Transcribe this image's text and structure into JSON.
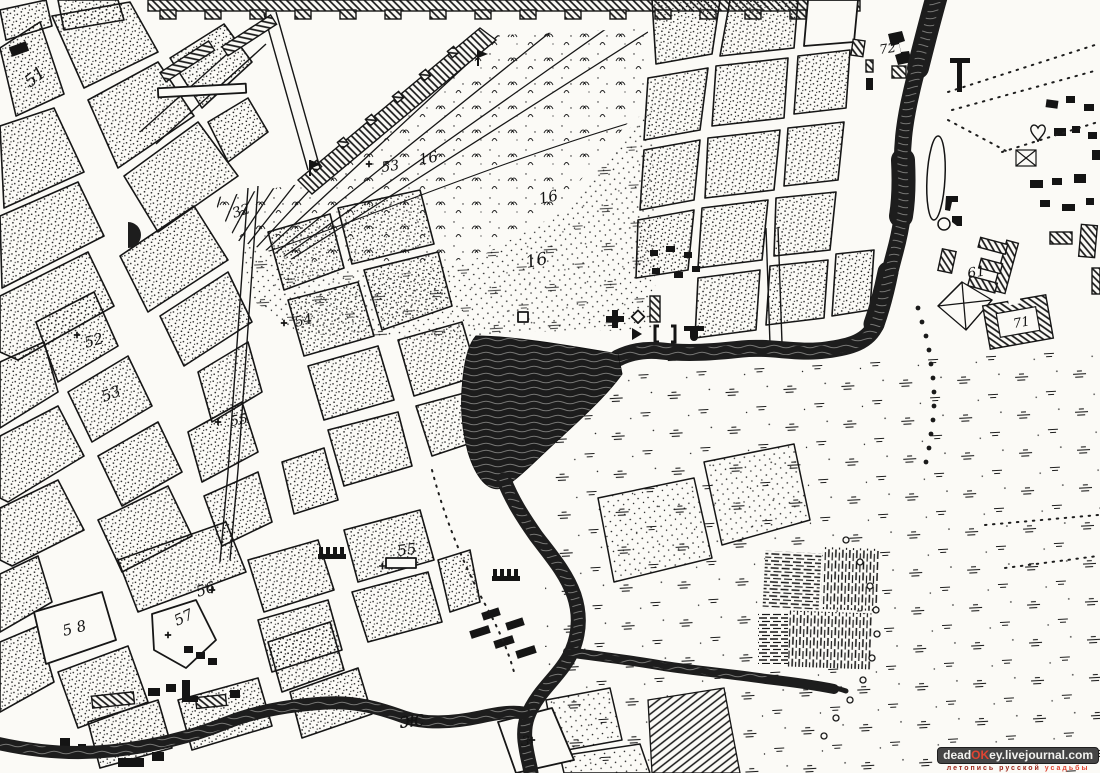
{
  "map": {
    "description": "engraved-town-plan-fragment",
    "labels": [
      {
        "text": "51",
        "x": 30,
        "y": 88,
        "rot": -38,
        "size": 17
      },
      {
        "text": "52",
        "x": 86,
        "y": 348,
        "rot": -16,
        "size": 15,
        "cross_dx": -9,
        "cross_dy": -13
      },
      {
        "text": "53",
        "x": 104,
        "y": 402,
        "rot": -22,
        "size": 15
      },
      {
        "text": "32",
        "x": 234,
        "y": 218,
        "rot": -18,
        "size": 14
      },
      {
        "text": "53",
        "x": 382,
        "y": 172,
        "rot": -8,
        "size": 14,
        "cross_dx": -13,
        "cross_dy": -8
      },
      {
        "text": "16",
        "x": 420,
        "y": 165,
        "rot": -12,
        "size": 15
      },
      {
        "text": "16",
        "x": 540,
        "y": 204,
        "rot": -12,
        "size": 15
      },
      {
        "text": "16",
        "x": 527,
        "y": 268,
        "rot": -12,
        "size": 17
      },
      {
        "text": "54",
        "x": 296,
        "y": 327,
        "rot": -14,
        "size": 14,
        "cross_dx": -12,
        "cross_dy": -4
      },
      {
        "text": "55",
        "x": 231,
        "y": 426,
        "rot": -10,
        "size": 14,
        "cross_dx": -13,
        "cross_dy": -4
      },
      {
        "text": "55",
        "x": 398,
        "y": 556,
        "rot": -8,
        "size": 15
      },
      {
        "text": "56",
        "x": 198,
        "y": 597,
        "rot": -18,
        "size": 15,
        "cross_dx": 14,
        "cross_dy": -7
      },
      {
        "text": "57",
        "x": 177,
        "y": 626,
        "rot": -25,
        "size": 15,
        "cross_dx": -9,
        "cross_dy": 9
      },
      {
        "text": "5 8",
        "x": 64,
        "y": 636,
        "rot": -14,
        "size": 15
      },
      {
        "text": "72",
        "x": 880,
        "y": 54,
        "rot": -8,
        "size": 13
      },
      {
        "text": "61",
        "x": 968,
        "y": 278,
        "rot": -8,
        "size": 14
      },
      {
        "text": "71",
        "x": 1014,
        "y": 328,
        "rot": -10,
        "size": 13
      },
      {
        "text": "ж",
        "x": 400,
        "y": 728,
        "rot": -6,
        "size": 22
      },
      {
        "text": "3",
        "x": 521,
        "y": 746,
        "rot": 0,
        "size": 14,
        "cross_dx": 11,
        "cross_dy": -6
      }
    ]
  },
  "colors": {
    "ink": "#161616",
    "paper": "#fbfaf6",
    "water": "#1d1d1d",
    "watermark_box": "#454545",
    "watermark_red": "#e04432"
  },
  "watermark": {
    "site_prefix": "dead",
    "site_accent": "OK",
    "site_suffix": "ey.livejournal.com",
    "tagline_main": "летопись русской",
    "tagline_accent": "усадьбы"
  }
}
